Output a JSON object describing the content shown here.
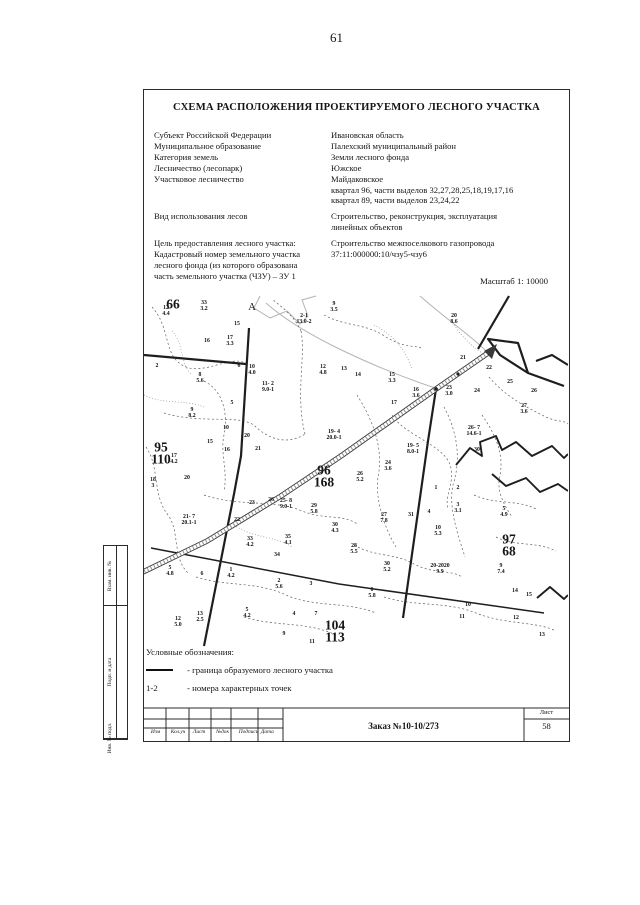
{
  "page": {
    "number": "61"
  },
  "header": {
    "title": "СХЕМА РАСПОЛОЖЕНИЯ ПРОЕКТИРУЕМОГО ЛЕСНОГО УЧАСТКА"
  },
  "scale": "Масштаб 1: 10000",
  "info": {
    "rows": [
      {
        "label": "Субъект Российской Федерации",
        "value": "Ивановская область"
      },
      {
        "label": "Муниципальное образование",
        "value": "Палехский муниципальный район"
      },
      {
        "label": "Категория земель",
        "value": "Земли лесного фонда"
      },
      {
        "label": "Лесничество (лесопарк)",
        "value": "Южское"
      },
      {
        "label": "Участковое лесничество",
        "value": "Майдаковское"
      },
      {
        "label": "",
        "value": "квартал 96,  части выделов 32,27,28,25,18,19,17,16"
      },
      {
        "label": "",
        "value": "квартал 89,  части выделов 23,24,22"
      },
      {
        "label": "Вид использования лесов",
        "value": "Строительство, реконструкция, эксплуатация",
        "gap": true
      },
      {
        "label": "",
        "value": "линейных объектов"
      },
      {
        "label": "Цель предоставления лесного участка:",
        "value": "Строительство межпоселкового газопровода",
        "gap": true
      },
      {
        "label": "Кадастровый номер земельного участка",
        "value": "37:11:000000:10/чзу5-чзу6"
      },
      {
        "label": "лесного фонда (из которого образована",
        "value": ""
      },
      {
        "label": "часть земельного участка (ЧЗУ) – ЗУ 1",
        "value": ""
      }
    ]
  },
  "map": {
    "area_label": "А",
    "quarters": [
      {
        "x": 29,
        "y": 9,
        "text": "66"
      },
      {
        "x": 17,
        "y": 158,
        "text": "95\n110"
      },
      {
        "x": 180,
        "y": 181,
        "text": "96\n168"
      },
      {
        "x": 365,
        "y": 250,
        "text": "97\n68"
      },
      {
        "x": 191,
        "y": 336,
        "text": "104\n113"
      }
    ],
    "labels": [
      {
        "x": 22,
        "y": 16,
        "text": "12\n4.4"
      },
      {
        "x": 60,
        "y": 11,
        "text": "33\n3.2"
      },
      {
        "x": 160,
        "y": 24,
        "text": "2-1\n13.0-2"
      },
      {
        "x": 190,
        "y": 12,
        "text": "9\n3.5"
      },
      {
        "x": 93,
        "y": 29,
        "text": "15"
      },
      {
        "x": 63,
        "y": 46,
        "text": "16"
      },
      {
        "x": 86,
        "y": 46,
        "text": "17\n3.3"
      },
      {
        "x": 13,
        "y": 71,
        "text": "2"
      },
      {
        "x": 95,
        "y": 71,
        "text": "6"
      },
      {
        "x": 108,
        "y": 75,
        "text": "10\n4.0"
      },
      {
        "x": 56,
        "y": 83,
        "text": "8\n5.6"
      },
      {
        "x": 124,
        "y": 92,
        "text": "11- 2\n9.0-1"
      },
      {
        "x": 179,
        "y": 75,
        "text": "12\n4.8"
      },
      {
        "x": 200,
        "y": 74,
        "text": "13"
      },
      {
        "x": 214,
        "y": 80,
        "text": "14"
      },
      {
        "x": 248,
        "y": 83,
        "text": "15\n3.3"
      },
      {
        "x": 272,
        "y": 98,
        "text": "16\n3.6"
      },
      {
        "x": 250,
        "y": 108,
        "text": "17"
      },
      {
        "x": 310,
        "y": 24,
        "text": "20\n8.6"
      },
      {
        "x": 319,
        "y": 63,
        "text": "21"
      },
      {
        "x": 345,
        "y": 73,
        "text": "22"
      },
      {
        "x": 305,
        "y": 96,
        "text": "23\n3.0"
      },
      {
        "x": 333,
        "y": 96,
        "text": "24"
      },
      {
        "x": 366,
        "y": 87,
        "text": "25"
      },
      {
        "x": 390,
        "y": 96,
        "text": "26"
      },
      {
        "x": 380,
        "y": 114,
        "text": "27\n3.6"
      },
      {
        "x": 330,
        "y": 136,
        "text": "26- 7\n14.6-1"
      },
      {
        "x": 333,
        "y": 155,
        "text": "30"
      },
      {
        "x": 88,
        "y": 108,
        "text": "5"
      },
      {
        "x": 48,
        "y": 118,
        "text": "9\n8.2"
      },
      {
        "x": 82,
        "y": 133,
        "text": "10"
      },
      {
        "x": 66,
        "y": 147,
        "text": "15"
      },
      {
        "x": 83,
        "y": 155,
        "text": "16"
      },
      {
        "x": 103,
        "y": 141,
        "text": "20"
      },
      {
        "x": 114,
        "y": 154,
        "text": "21"
      },
      {
        "x": 190,
        "y": 140,
        "text": "19- 4\n20.0-1"
      },
      {
        "x": 269,
        "y": 154,
        "text": "19- 5\n8.0-1"
      },
      {
        "x": 30,
        "y": 164,
        "text": "17\n4.2"
      },
      {
        "x": 9,
        "y": 188,
        "text": "18\n3"
      },
      {
        "x": 43,
        "y": 183,
        "text": "20"
      },
      {
        "x": 45,
        "y": 225,
        "text": "21- 7\n20.1-1"
      },
      {
        "x": 93,
        "y": 225,
        "text": "22"
      },
      {
        "x": 108,
        "y": 208,
        "text": "23"
      },
      {
        "x": 127,
        "y": 205,
        "text": "26"
      },
      {
        "x": 142,
        "y": 209,
        "text": "25- 8\n9.0-1"
      },
      {
        "x": 170,
        "y": 214,
        "text": "29\n5.8"
      },
      {
        "x": 191,
        "y": 233,
        "text": "30\n4.3"
      },
      {
        "x": 106,
        "y": 247,
        "text": "33\n4.2"
      },
      {
        "x": 144,
        "y": 245,
        "text": "35\n4.1"
      },
      {
        "x": 133,
        "y": 260,
        "text": "34"
      },
      {
        "x": 244,
        "y": 171,
        "text": "24\n3.6"
      },
      {
        "x": 216,
        "y": 182,
        "text": "26\n5.2"
      },
      {
        "x": 240,
        "y": 223,
        "text": "27\n7.8"
      },
      {
        "x": 210,
        "y": 254,
        "text": "28\n5.5"
      },
      {
        "x": 243,
        "y": 272,
        "text": "30\n5.2"
      },
      {
        "x": 267,
        "y": 220,
        "text": "31"
      },
      {
        "x": 285,
        "y": 217,
        "text": "4"
      },
      {
        "x": 292,
        "y": 193,
        "text": "1"
      },
      {
        "x": 314,
        "y": 193,
        "text": "2"
      },
      {
        "x": 314,
        "y": 213,
        "text": "3\n3.1"
      },
      {
        "x": 360,
        "y": 217,
        "text": "5\n4.9"
      },
      {
        "x": 294,
        "y": 236,
        "text": "10\n5.3"
      },
      {
        "x": 296,
        "y": 274,
        "text": "20-2020\n9.9"
      },
      {
        "x": 357,
        "y": 274,
        "text": "9\n7.4"
      },
      {
        "x": 26,
        "y": 276,
        "text": "5\n4.8"
      },
      {
        "x": 58,
        "y": 279,
        "text": "6"
      },
      {
        "x": 87,
        "y": 278,
        "text": "1\n4.2"
      },
      {
        "x": 135,
        "y": 289,
        "text": "2\n5.6"
      },
      {
        "x": 167,
        "y": 289,
        "text": "3"
      },
      {
        "x": 228,
        "y": 298,
        "text": "6\n5.8"
      },
      {
        "x": 324,
        "y": 310,
        "text": "10"
      },
      {
        "x": 371,
        "y": 296,
        "text": "14"
      },
      {
        "x": 385,
        "y": 300,
        "text": "15"
      },
      {
        "x": 318,
        "y": 322,
        "text": "11"
      },
      {
        "x": 372,
        "y": 323,
        "text": "12"
      },
      {
        "x": 398,
        "y": 340,
        "text": "13"
      },
      {
        "x": 103,
        "y": 318,
        "text": "5\n4.2"
      },
      {
        "x": 56,
        "y": 322,
        "text": "13\n2.5"
      },
      {
        "x": 34,
        "y": 327,
        "text": "12\n5.0"
      },
      {
        "x": 150,
        "y": 319,
        "text": "4"
      },
      {
        "x": 172,
        "y": 319,
        "text": "7"
      },
      {
        "x": 140,
        "y": 339,
        "text": "9"
      },
      {
        "x": 168,
        "y": 347,
        "text": "11"
      }
    ]
  },
  "legend": {
    "heading": "Условные обозначения:",
    "boundary_item": {
      "label": "- граница образуемого лесного участка"
    },
    "points_item": {
      "symbol": "1-2",
      "label": "- номера характерных точек"
    }
  },
  "title_block": {
    "columns": [
      "Изм",
      "Кол.уч",
      "Лист",
      "№док",
      "Подпись",
      "Дата"
    ],
    "order": "Заказ №10-10/273",
    "sheet_label": "Лист",
    "sheet_number": "58",
    "side_labels": [
      "Взам. инв. №",
      "Подп. и дата",
      "Инв. № подл."
    ]
  },
  "colors": {
    "ink": "#151515",
    "boundary_band": "#8d8d8d"
  }
}
